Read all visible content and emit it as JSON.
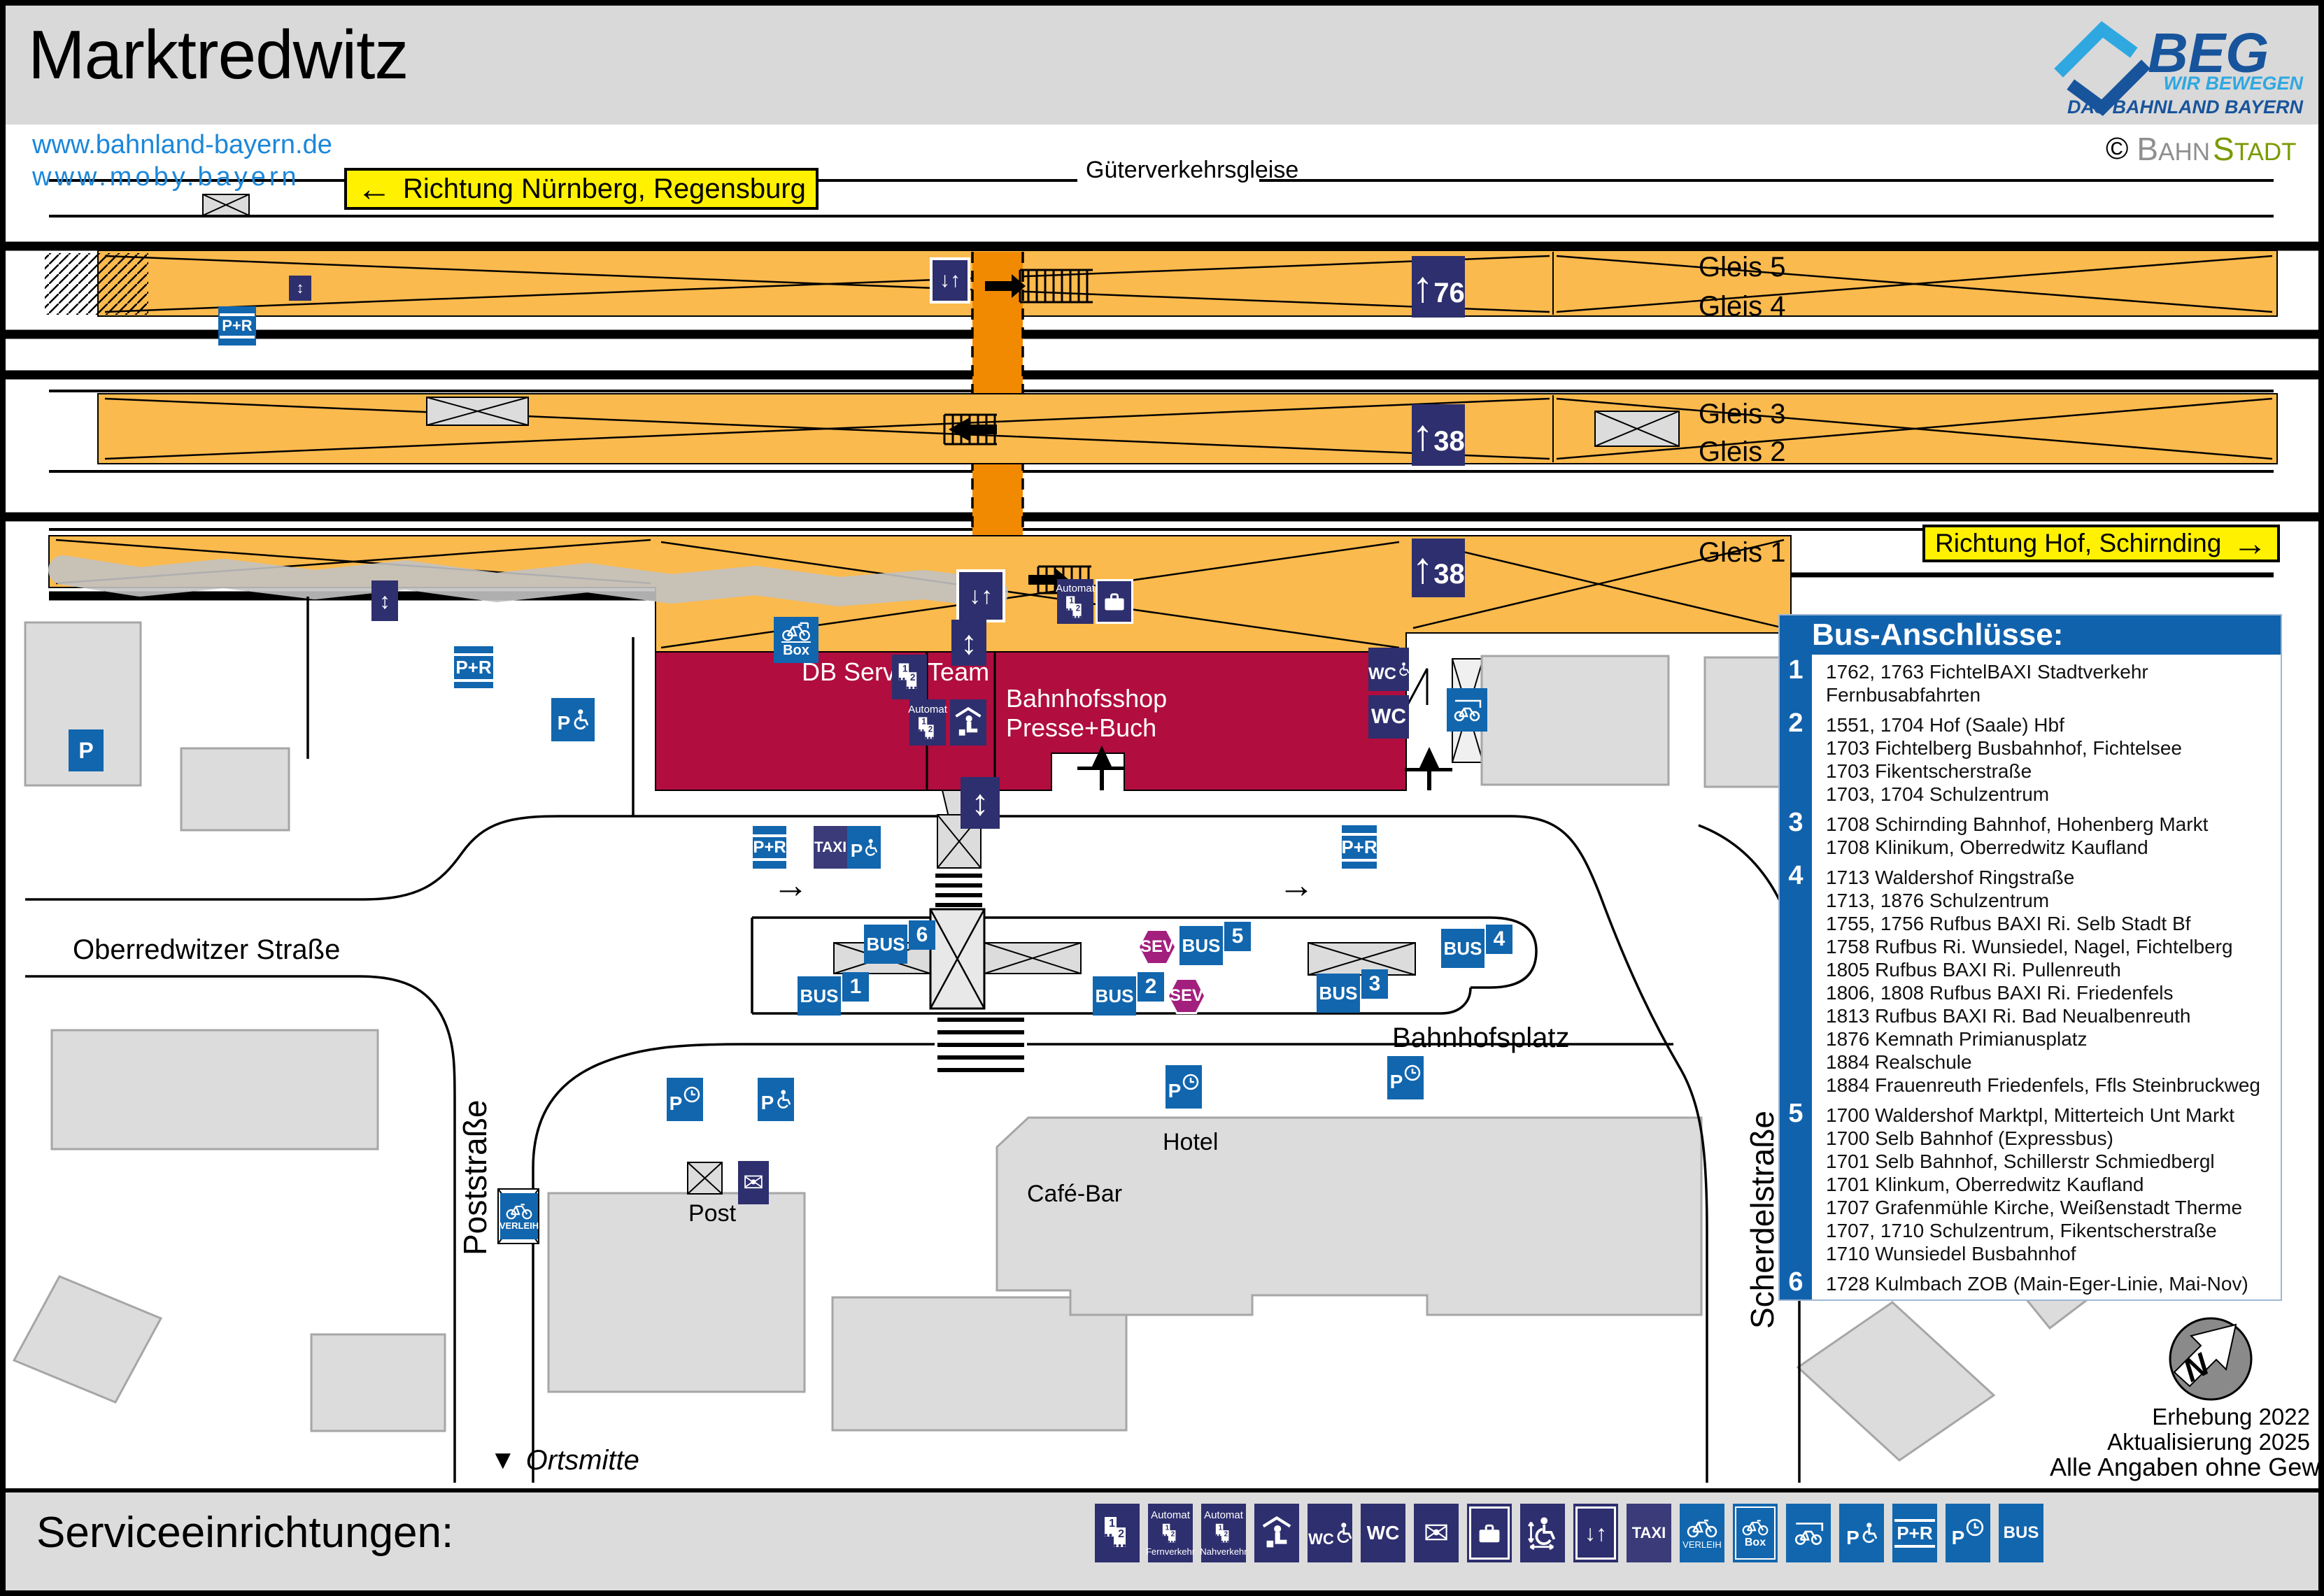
{
  "title": "Marktredwitz",
  "links": {
    "l1": "www.bahnland-bayern.de",
    "l2": "www.moby.bayern"
  },
  "brand": {
    "beg": "BEG",
    "tag1": "WIR BEWEGEN",
    "tag2": "DAS BAHNLAND BAYERN",
    "copy": "©",
    "bahn_b": "B",
    "bahn_rest": "AHN",
    "stadt_b": "S",
    "stadt_rest": "TADT"
  },
  "directions": {
    "west": "Richtung Nürnberg, Regensburg",
    "east": "Richtung Hof, Schirnding"
  },
  "tracks": {
    "goods": "Güterverkehrsgleise",
    "g5": "Gleis 5",
    "g4": "Gleis 4",
    "g3": "Gleis 3",
    "g2": "Gleis 2",
    "g1": "Gleis 1",
    "len76": "76",
    "len38": "38"
  },
  "station": {
    "db": "DB ServiceTeam",
    "shop1": "Bahnhofsshop",
    "shop2": "Presse+Buch"
  },
  "labels": {
    "bus": "BUS",
    "sev": "SEV",
    "taxi": "TAXI",
    "pr": "P+R",
    "p": "P",
    "wc": "WC",
    "box": "Box",
    "verleih": "VERLEIH",
    "automat": "Automat",
    "fern": "Fernverkehr",
    "nah": "Nahverkehr"
  },
  "stops": {
    "n1": "1",
    "n2": "2",
    "n3": "3",
    "n4": "4",
    "n5": "5",
    "n6": "6"
  },
  "glyphs": {
    "left": "←",
    "right": "→",
    "up": "↑",
    "updown": "↕",
    "downup": "↓↑",
    "tridown": "▼",
    "envelope": "✉"
  },
  "streets": {
    "oberredwitzer": "Oberredwitzer Straße",
    "poststrasse": "Poststraße",
    "scherdelstrasse": "Scherdelstraße",
    "bahnhofsplatz": "Bahnhofsplatz",
    "ortsmitte": "Ortsmitte"
  },
  "places": {
    "hotel": "Hotel",
    "cafe": "Café-Bar",
    "post": "Post"
  },
  "bus_panel": {
    "title": "Bus-Anschlüsse:",
    "groups": [
      {
        "num": "1",
        "lines": [
          "1762, 1763 FichtelBAXI Stadtverkehr",
          "Fernbusabfahrten"
        ]
      },
      {
        "num": "2",
        "lines": [
          "1551, 1704 Hof (Saale) Hbf",
          "1703 Fichtelberg Busbahnhof, Fichtelsee",
          "1703 Fikentscherstraße",
          "1703, 1704 Schulzentrum"
        ]
      },
      {
        "num": "3",
        "lines": [
          "1708 Schirnding Bahnhof, Hohenberg Markt",
          "1708 Klinikum, Oberredwitz Kaufland"
        ]
      },
      {
        "num": "4",
        "lines": [
          "1713 Waldershof Ringstraße",
          "1713, 1876 Schulzentrum",
          "1755, 1756 Rufbus BAXI Ri. Selb Stadt Bf",
          "1758 Rufbus Ri. Wunsiedel, Nagel, Fichtelberg",
          "1805 Rufbus BAXI Ri. Pullenreuth",
          "1806, 1808 Rufbus BAXI Ri. Friedenfels",
          "1813 Rufbus BAXI Ri. Bad Neualbenreuth",
          "1876 Kemnath Primianusplatz",
          "1884 Realschule",
          "1884 Frauenreuth Friedenfels, Ffls Steinbruckweg"
        ]
      },
      {
        "num": "5",
        "lines": [
          "1700 Waldershof Marktpl, Mitterteich Unt Markt",
          "1700 Selb Bahnhof (Expressbus)",
          "1701 Selb Bahnhof, Schillerstr Schmiedbergl",
          "1701 Klinkum, Oberredwitz Kaufland",
          "1707 Grafenmühle Kirche, Weißenstadt Therme",
          "1707, 1710 Schulzentrum, Fikentscherstraße",
          "1710 Wunsiedel Busbahnhof"
        ]
      },
      {
        "num": "6",
        "lines": [
          "1728 Kulmbach ZOB (Main-Eger-Linie, Mai-Nov)"
        ]
      }
    ]
  },
  "footer": {
    "title": "Serviceeinrichtungen:"
  },
  "notes": {
    "l1": "Erhebung 2022",
    "l2": "Aktualisierung 2025",
    "l3": "Alle Angaben ohne Gewähr!"
  },
  "compass": {
    "n": "N"
  },
  "colors": {
    "navy": "#2E2F6E",
    "blue": "#1166AE",
    "sev": "#A31F7E",
    "building": "#B10D3F",
    "platform": "#FBBA4D",
    "underpass": "#F18A00",
    "yellow": "#FFF100",
    "link": "#1C87D9",
    "panel": "#1162AD",
    "beg_dark": "#17549C",
    "beg_light": "#2FA8E1",
    "stadt_green": "#7A9A01"
  }
}
